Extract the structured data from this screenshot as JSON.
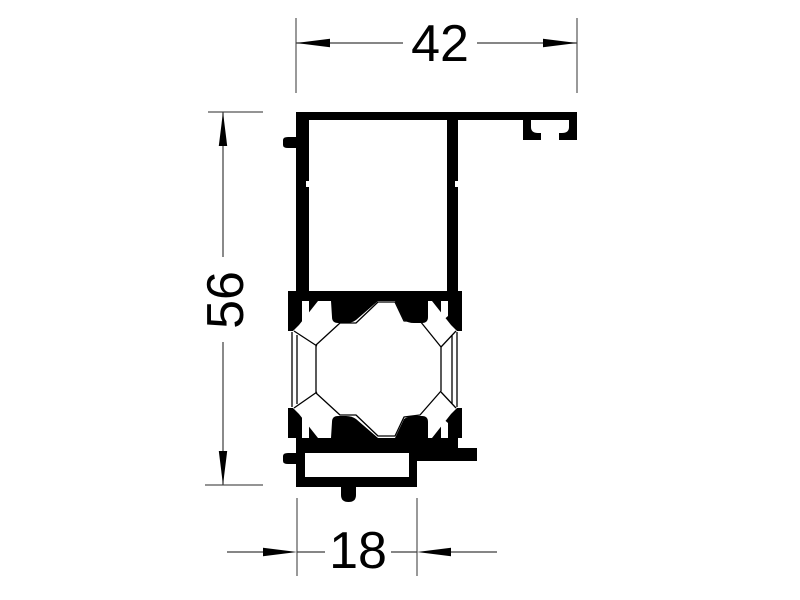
{
  "drawing": {
    "title": "extruded-profile-cross-section",
    "background_color": "#ffffff",
    "profile_color": "#000000",
    "dimension_color": "#3d3d3d",
    "dimensions": {
      "top_width": "42",
      "overall_height": "56",
      "bottom_width": "18"
    }
  }
}
